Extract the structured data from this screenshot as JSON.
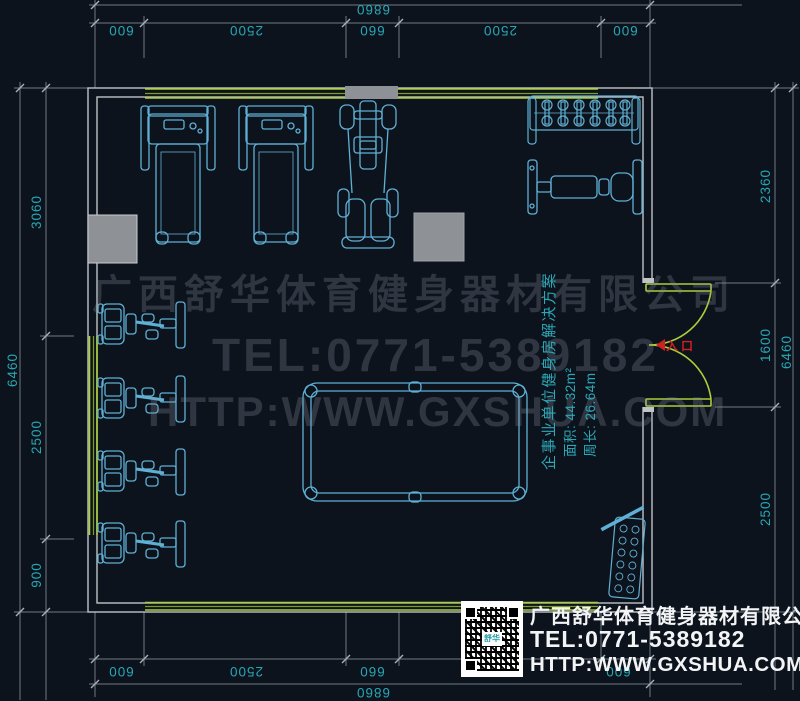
{
  "title": "企事业单位健身房平面布置图",
  "colors": {
    "background": "#0d131c",
    "wall_gray": "#c0c4c8",
    "window_green": "#9acd32",
    "equipment_cyan": "#5fb0d4",
    "dim_line_gray": "#6f7882",
    "dim_text_teal": "#27a6b4",
    "watermark_gray": "#39404b",
    "entrance_red": "#d02020",
    "block_gray": "#8e9296",
    "contact_white": "#f2f4f6"
  },
  "dimensions": {
    "top": {
      "overall": "6860",
      "seg1": "600",
      "seg2": "2500",
      "seg3": "660",
      "seg4": "2500",
      "seg5": "600"
    },
    "bottom": {
      "overall": "6860",
      "seg1": "600",
      "seg2": "2500",
      "seg3": "660",
      "seg4": "2500",
      "seg5": "600"
    },
    "left": {
      "overall": "6460",
      "seg1": "3060",
      "seg2": "2500",
      "seg3": "900"
    },
    "right": {
      "overall": "6460",
      "seg1": "2360",
      "seg2": "1600",
      "seg3": "2500"
    }
  },
  "watermark": {
    "company": "广西舒华体育健身器材有限公司",
    "tel": "TEL:0771-5389182",
    "url": "HTTP:WWW.GXSHUA.COM"
  },
  "info_block": {
    "title": "企事业单位健身房解决方案",
    "area": "面积: 44.32m²",
    "perimeter": "周长: 26.64m"
  },
  "door": {
    "label": "入口"
  },
  "contact": {
    "company": "广西舒华体育健身器材有限公司",
    "tel": "TEL:0771-5389182",
    "url": "HTTP:WWW.GXSHUA.COM",
    "qr_center": "舒华"
  },
  "equipment": [
    "treadmill",
    "treadmill",
    "multi-station-gym",
    "dumbbell-rack",
    "weight-bench",
    "strength-machine",
    "strength-machine",
    "strength-machine",
    "strength-machine",
    "billiard-table",
    "plate-rack"
  ]
}
